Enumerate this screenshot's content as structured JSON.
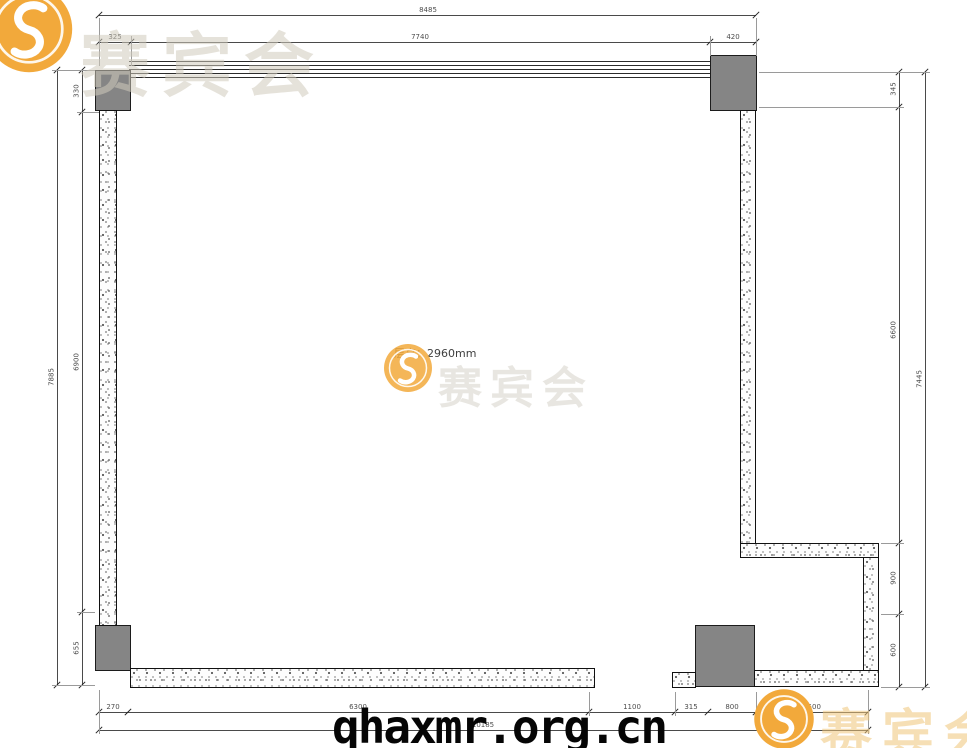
{
  "plan": {
    "room_label": "层高：2960mm",
    "dims": {
      "top_total": "8485",
      "top_segments": [
        "325",
        "7740",
        "420"
      ],
      "left_total": "7885",
      "left_segments": [
        "330",
        "6900",
        "655"
      ],
      "right_total": "7445",
      "right_segments": [
        "345",
        "6600",
        "900",
        "600"
      ],
      "bottom_total": "10185",
      "bottom_segments": [
        "270",
        "6300",
        "1100",
        "315",
        "800",
        "1500"
      ]
    }
  },
  "watermark": {
    "url": "qhaxmr.org.cn",
    "brand": "赛宾会",
    "logo_letter": "S",
    "logo_color": "#F2A93B"
  }
}
